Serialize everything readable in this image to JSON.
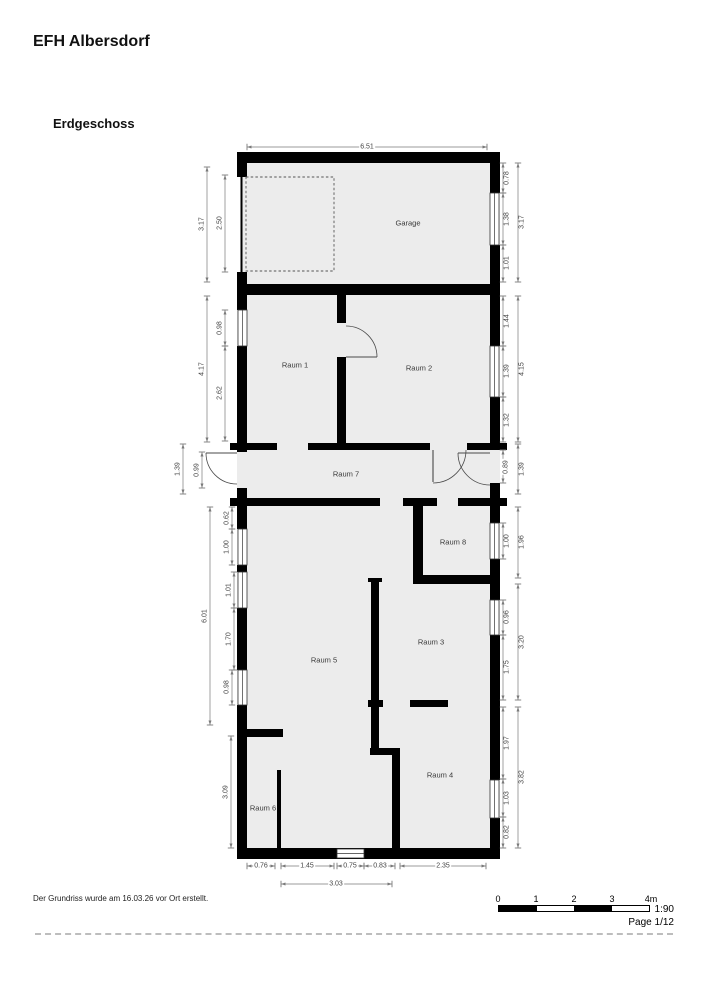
{
  "page": {
    "title": "EFH Albersdorf",
    "floor_label": "Erdgeschoss",
    "footer_note": "Der Grundriss wurde am 16.03.26 vor Ort erstellt.",
    "scale_text": "1:90",
    "page_number": "Page 1/12"
  },
  "rooms": [
    {
      "name": "Garage"
    },
    {
      "name": "Raum 1"
    },
    {
      "name": "Raum 2"
    },
    {
      "name": "Raum 7"
    },
    {
      "name": "Raum 8"
    },
    {
      "name": "Raum 3"
    },
    {
      "name": "Raum 5"
    },
    {
      "name": "Raum 4"
    },
    {
      "name": "Raum 6"
    }
  ],
  "dims": {
    "top": [
      "6.51"
    ],
    "left_outer": [
      "3.17",
      "4.17",
      "1.39",
      "6.01",
      "3.09"
    ],
    "left_inner": [
      "2.50",
      "0.98",
      "2.62",
      "0.99",
      "0.62",
      "1.00",
      "1.01",
      "1.70",
      "0.98"
    ],
    "right_inner": [
      "0.78",
      "1.38",
      "1.01",
      "1.44",
      "1.39",
      "1.32",
      "0.89",
      "1.00",
      "0.96",
      "1.75",
      "1.97",
      "1.03",
      "0.82"
    ],
    "right_outer": [
      "3.17",
      "4.15",
      "1.39",
      "1.96",
      "3.20",
      "3.82"
    ],
    "bottom": [
      "0.76",
      "1.45",
      "0.75",
      "0.83",
      "2.35",
      "3.03"
    ]
  },
  "scalebar": {
    "ticks": [
      "0",
      "1",
      "2",
      "3",
      "4m"
    ]
  },
  "colors": {
    "wall": "#000000",
    "floor": "#ececec",
    "dim_line": "#7a7a7a",
    "accent_text": "#444444"
  }
}
